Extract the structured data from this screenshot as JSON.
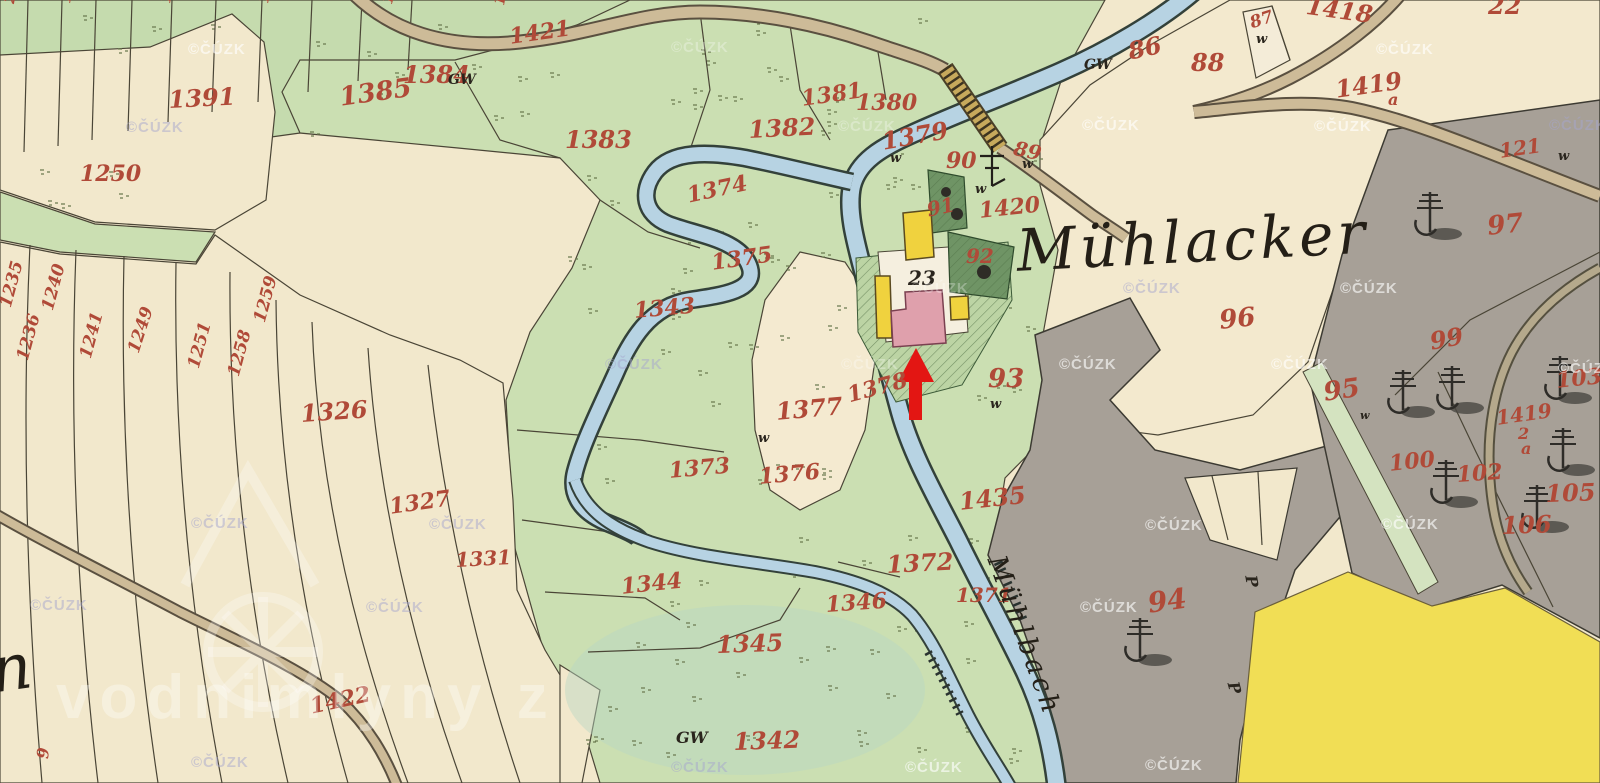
{
  "map": {
    "settlement_name": "Mühlacker",
    "stream_name": "Mühlbach",
    "left_edge_script_fragment": "n",
    "watermark_copyright": "©ČÚZK",
    "watermark_site": "vodnimlyny z",
    "annotation": {
      "type": "red-arrow",
      "points_to": "pink mill building at parcel 23"
    },
    "colors": {
      "paper": "#f2e8cc",
      "meadow": "#cbdfb2",
      "pale_meadow": "#dce8ca",
      "water": "#b7d3e3",
      "road": "#cdbb98",
      "bridge": "#c7a95c",
      "forest_gray": "#a7a097",
      "field_yellow": "#f1de55",
      "building_yellow": "#f0d23e",
      "building_pink": "#dfa0ac",
      "garden_green": "#6f9465",
      "number_red": "#b04a38",
      "ink": "#2a251d",
      "arrow_red": "#e31613"
    }
  },
  "labels": [
    {
      "t": "1421",
      "x": 508,
      "y": 26,
      "s": 22,
      "r": -8,
      "c": "red"
    },
    {
      "t": "1384",
      "x": 403,
      "y": 63,
      "s": 24,
      "r": 0,
      "c": "red"
    },
    {
      "t": "1385",
      "x": 338,
      "y": 85,
      "s": 26,
      "r": -8,
      "c": "red"
    },
    {
      "t": "1391",
      "x": 168,
      "y": 88,
      "s": 24,
      "r": -3,
      "c": "red"
    },
    {
      "t": "1250",
      "x": 80,
      "y": 163,
      "s": 22,
      "r": 0,
      "c": "red"
    },
    {
      "t": "1383",
      "x": 565,
      "y": 128,
      "s": 24,
      "r": 0,
      "c": "red"
    },
    {
      "t": "1382",
      "x": 748,
      "y": 118,
      "s": 24,
      "r": -3,
      "c": "red"
    },
    {
      "t": "1381",
      "x": 800,
      "y": 88,
      "s": 22,
      "r": -8,
      "c": "red"
    },
    {
      "t": "1380",
      "x": 856,
      "y": 92,
      "s": 22,
      "r": 0,
      "c": "red"
    },
    {
      "t": "1379",
      "x": 880,
      "y": 130,
      "s": 24,
      "r": -10,
      "c": "red"
    },
    {
      "t": "86",
      "x": 1126,
      "y": 40,
      "s": 24,
      "r": -12,
      "c": "red"
    },
    {
      "t": "88",
      "x": 1191,
      "y": 51,
      "s": 24,
      "r": 0,
      "c": "red"
    },
    {
      "t": "87",
      "x": 1248,
      "y": 16,
      "s": 17,
      "r": -18,
      "c": "red"
    },
    {
      "t": "1418",
      "x": 1308,
      "y": -6,
      "s": 24,
      "r": 8,
      "c": "red"
    },
    {
      "t": "22",
      "x": 1488,
      "y": -6,
      "s": 24,
      "r": 0,
      "c": "red"
    },
    {
      "t": "1419",
      "x": 1334,
      "y": 78,
      "s": 24,
      "r": -8,
      "c": "red"
    },
    {
      "t": "a",
      "x": 1388,
      "y": 92,
      "s": 16,
      "r": 0,
      "c": "red"
    },
    {
      "t": "121",
      "x": 1498,
      "y": 141,
      "s": 20,
      "r": -8,
      "c": "red"
    },
    {
      "t": "90",
      "x": 946,
      "y": 150,
      "s": 22,
      "r": 0,
      "c": "red"
    },
    {
      "t": "89",
      "x": 1016,
      "y": 138,
      "s": 20,
      "r": 12,
      "c": "red"
    },
    {
      "t": "91",
      "x": 925,
      "y": 200,
      "s": 20,
      "r": -12,
      "c": "red"
    },
    {
      "t": "1420",
      "x": 978,
      "y": 200,
      "s": 22,
      "r": -6,
      "c": "red"
    },
    {
      "t": "92",
      "x": 966,
      "y": 246,
      "s": 20,
      "r": 0,
      "c": "red"
    },
    {
      "t": "93",
      "x": 988,
      "y": 366,
      "s": 26,
      "r": 0,
      "c": "red"
    },
    {
      "t": "96",
      "x": 1218,
      "y": 308,
      "s": 26,
      "r": -6,
      "c": "red"
    },
    {
      "t": "97",
      "x": 1486,
      "y": 214,
      "s": 26,
      "r": -6,
      "c": "red"
    },
    {
      "t": "99",
      "x": 1428,
      "y": 330,
      "s": 24,
      "r": -10,
      "c": "red"
    },
    {
      "t": "95",
      "x": 1322,
      "y": 380,
      "s": 26,
      "r": -8,
      "c": "red"
    },
    {
      "t": "1374",
      "x": 685,
      "y": 185,
      "s": 22,
      "r": -12,
      "c": "red"
    },
    {
      "t": "1375",
      "x": 710,
      "y": 252,
      "s": 22,
      "r": -8,
      "c": "red"
    },
    {
      "t": "1343",
      "x": 633,
      "y": 300,
      "s": 22,
      "r": -5,
      "c": "red"
    },
    {
      "t": "1377",
      "x": 775,
      "y": 400,
      "s": 24,
      "r": -5,
      "c": "red"
    },
    {
      "t": "1378",
      "x": 845,
      "y": 385,
      "s": 22,
      "r": -15,
      "c": "red"
    },
    {
      "t": "1326",
      "x": 300,
      "y": 402,
      "s": 24,
      "r": -4,
      "c": "red"
    },
    {
      "t": "1327",
      "x": 388,
      "y": 496,
      "s": 22,
      "r": -8,
      "c": "red"
    },
    {
      "t": "1331",
      "x": 455,
      "y": 550,
      "s": 20,
      "r": -3,
      "c": "red"
    },
    {
      "t": "1373",
      "x": 668,
      "y": 460,
      "s": 22,
      "r": -5,
      "c": "red"
    },
    {
      "t": "1376",
      "x": 758,
      "y": 466,
      "s": 22,
      "r": -5,
      "c": "red"
    },
    {
      "t": "1435",
      "x": 958,
      "y": 490,
      "s": 24,
      "r": -6,
      "c": "red"
    },
    {
      "t": "1344",
      "x": 620,
      "y": 576,
      "s": 22,
      "r": -6,
      "c": "red"
    },
    {
      "t": "1346",
      "x": 825,
      "y": 594,
      "s": 22,
      "r": -4,
      "c": "red"
    },
    {
      "t": "1345",
      "x": 716,
      "y": 633,
      "s": 24,
      "r": -2,
      "c": "red"
    },
    {
      "t": "1372",
      "x": 886,
      "y": 553,
      "s": 24,
      "r": -3,
      "c": "red"
    },
    {
      "t": "1371",
      "x": 956,
      "y": 585,
      "s": 20,
      "r": 0,
      "c": "red"
    },
    {
      "t": "1342",
      "x": 733,
      "y": 730,
      "s": 24,
      "r": -2,
      "c": "red"
    },
    {
      "t": "94",
      "x": 1146,
      "y": 590,
      "s": 28,
      "r": -8,
      "c": "red"
    },
    {
      "t": "100",
      "x": 1388,
      "y": 453,
      "s": 22,
      "r": -6,
      "c": "red"
    },
    {
      "t": "102",
      "x": 1456,
      "y": 464,
      "s": 22,
      "r": -4,
      "c": "red"
    },
    {
      "t": "103",
      "x": 1555,
      "y": 370,
      "s": 22,
      "r": -6,
      "c": "red"
    },
    {
      "t": "1419",
      "x": 1495,
      "y": 408,
      "s": 20,
      "r": -8,
      "c": "red"
    },
    {
      "t": "2",
      "x": 1518,
      "y": 426,
      "s": 16,
      "r": 0,
      "c": "red"
    },
    {
      "t": "a",
      "x": 1521,
      "y": 441,
      "s": 16,
      "r": 0,
      "c": "red"
    },
    {
      "t": "105",
      "x": 1545,
      "y": 482,
      "s": 24,
      "r": -2,
      "c": "red"
    },
    {
      "t": "106",
      "x": 1501,
      "y": 514,
      "s": 24,
      "r": -2,
      "c": "red"
    },
    {
      "t": "1422",
      "x": 308,
      "y": 696,
      "s": 22,
      "r": -12,
      "c": "red"
    },
    {
      "t": "9",
      "x": 35,
      "y": 758,
      "s": 16,
      "r": -85,
      "c": "red"
    },
    {
      "t": "1235",
      "x": -2,
      "y": 305,
      "s": 17,
      "r": -75,
      "c": "red"
    },
    {
      "t": "1236",
      "x": 15,
      "y": 358,
      "s": 17,
      "r": -75,
      "c": "red"
    },
    {
      "t": "1240",
      "x": 40,
      "y": 308,
      "s": 17,
      "r": -75,
      "c": "red"
    },
    {
      "t": "1241",
      "x": 78,
      "y": 356,
      "s": 17,
      "r": -75,
      "c": "red"
    },
    {
      "t": "1249",
      "x": 126,
      "y": 350,
      "s": 17,
      "r": -72,
      "c": "red"
    },
    {
      "t": "1251",
      "x": 186,
      "y": 366,
      "s": 17,
      "r": -75,
      "c": "red"
    },
    {
      "t": "1258",
      "x": 226,
      "y": 374,
      "s": 17,
      "r": -75,
      "c": "red"
    },
    {
      "t": "1259",
      "x": 252,
      "y": 320,
      "s": 17,
      "r": -75,
      "c": "red"
    },
    {
      "t": "294",
      "x": 2,
      "y": 2,
      "s": 15,
      "r": -80,
      "c": "red"
    },
    {
      "t": "13",
      "x": 58,
      "y": 2,
      "s": 15,
      "r": -80,
      "c": "red"
    },
    {
      "t": "121",
      "x": 158,
      "y": 2,
      "s": 15,
      "r": -80,
      "c": "red"
    },
    {
      "t": "13",
      "x": 256,
      "y": 2,
      "s": 15,
      "r": -80,
      "c": "red"
    },
    {
      "t": "138",
      "x": 380,
      "y": 2,
      "s": 15,
      "r": -75,
      "c": "red"
    },
    {
      "t": "12",
      "x": 492,
      "y": 4,
      "s": 15,
      "r": -80,
      "c": "red"
    },
    {
      "t": "23",
      "x": 908,
      "y": 268,
      "s": 20,
      "r": 0,
      "c": "blk"
    },
    {
      "t": "GW",
      "x": 448,
      "y": 73,
      "s": 14,
      "r": 0,
      "c": "blk"
    },
    {
      "t": "GW",
      "x": 1084,
      "y": 58,
      "s": 14,
      "r": 0,
      "c": "blk"
    },
    {
      "t": "GW",
      "x": 676,
      "y": 730,
      "s": 16,
      "r": 0,
      "c": "blk"
    },
    {
      "t": "w",
      "x": 890,
      "y": 152,
      "s": 13,
      "r": 0,
      "c": "blk"
    },
    {
      "t": "w",
      "x": 975,
      "y": 183,
      "s": 13,
      "r": 0,
      "c": "blk"
    },
    {
      "t": "w",
      "x": 1022,
      "y": 158,
      "s": 13,
      "r": 0,
      "c": "blk"
    },
    {
      "t": "w",
      "x": 1256,
      "y": 33,
      "s": 13,
      "r": 0,
      "c": "blk"
    },
    {
      "t": "w",
      "x": 1558,
      "y": 150,
      "s": 13,
      "r": 0,
      "c": "blk"
    },
    {
      "t": "w",
      "x": 990,
      "y": 398,
      "s": 13,
      "r": 0,
      "c": "blk"
    },
    {
      "t": "w",
      "x": 758,
      "y": 432,
      "s": 13,
      "r": 0,
      "c": "blk"
    },
    {
      "t": "w",
      "x": 1360,
      "y": 410,
      "s": 11,
      "r": 0,
      "c": "blk"
    },
    {
      "t": "P",
      "x": 1258,
      "y": 574,
      "s": 16,
      "r": 80,
      "c": "blk"
    },
    {
      "t": "P",
      "x": 1240,
      "y": 680,
      "s": 16,
      "r": 75,
      "c": "blk"
    },
    {
      "t": "Mühlacker",
      "x": 1015,
      "y": 222,
      "s": 58,
      "r": -3,
      "c": "sc"
    },
    {
      "t": "Mühlbach",
      "x": 1008,
      "y": 552,
      "s": 27,
      "r": 70,
      "c": "sc"
    },
    {
      "t": "n",
      "x": -14,
      "y": 640,
      "s": 64,
      "r": -8,
      "c": "sc"
    }
  ],
  "watermarks": [
    {
      "x": 188,
      "y": 42,
      "v": "w"
    },
    {
      "x": 671,
      "y": 40,
      "v": "f"
    },
    {
      "x": 1376,
      "y": 42,
      "v": "w"
    },
    {
      "x": 126,
      "y": 120,
      "v": "g"
    },
    {
      "x": 838,
      "y": 119,
      "v": "f"
    },
    {
      "x": 1082,
      "y": 118,
      "v": "w"
    },
    {
      "x": 1314,
      "y": 119,
      "v": "w"
    },
    {
      "x": 1549,
      "y": 118,
      "v": "g"
    },
    {
      "x": 911,
      "y": 281,
      "v": "f"
    },
    {
      "x": 1123,
      "y": 281,
      "v": "g"
    },
    {
      "x": 1340,
      "y": 281,
      "v": "w"
    },
    {
      "x": 605,
      "y": 357,
      "v": "g"
    },
    {
      "x": 841,
      "y": 357,
      "v": "f"
    },
    {
      "x": 1059,
      "y": 357,
      "v": "w"
    },
    {
      "x": 1271,
      "y": 357,
      "v": "w"
    },
    {
      "x": 1558,
      "y": 361,
      "v": "w"
    },
    {
      "x": 191,
      "y": 516,
      "v": "g"
    },
    {
      "x": 429,
      "y": 517,
      "v": "g"
    },
    {
      "x": 1145,
      "y": 518,
      "v": "w"
    },
    {
      "x": 1381,
      "y": 517,
      "v": "w"
    },
    {
      "x": 30,
      "y": 598,
      "v": "g"
    },
    {
      "x": 366,
      "y": 600,
      "v": "g"
    },
    {
      "x": 1080,
      "y": 600,
      "v": "w"
    },
    {
      "x": 191,
      "y": 755,
      "v": "g"
    },
    {
      "x": 671,
      "y": 760,
      "v": "g"
    },
    {
      "x": 905,
      "y": 760,
      "v": "w"
    },
    {
      "x": 1145,
      "y": 758,
      "v": "w"
    }
  ]
}
